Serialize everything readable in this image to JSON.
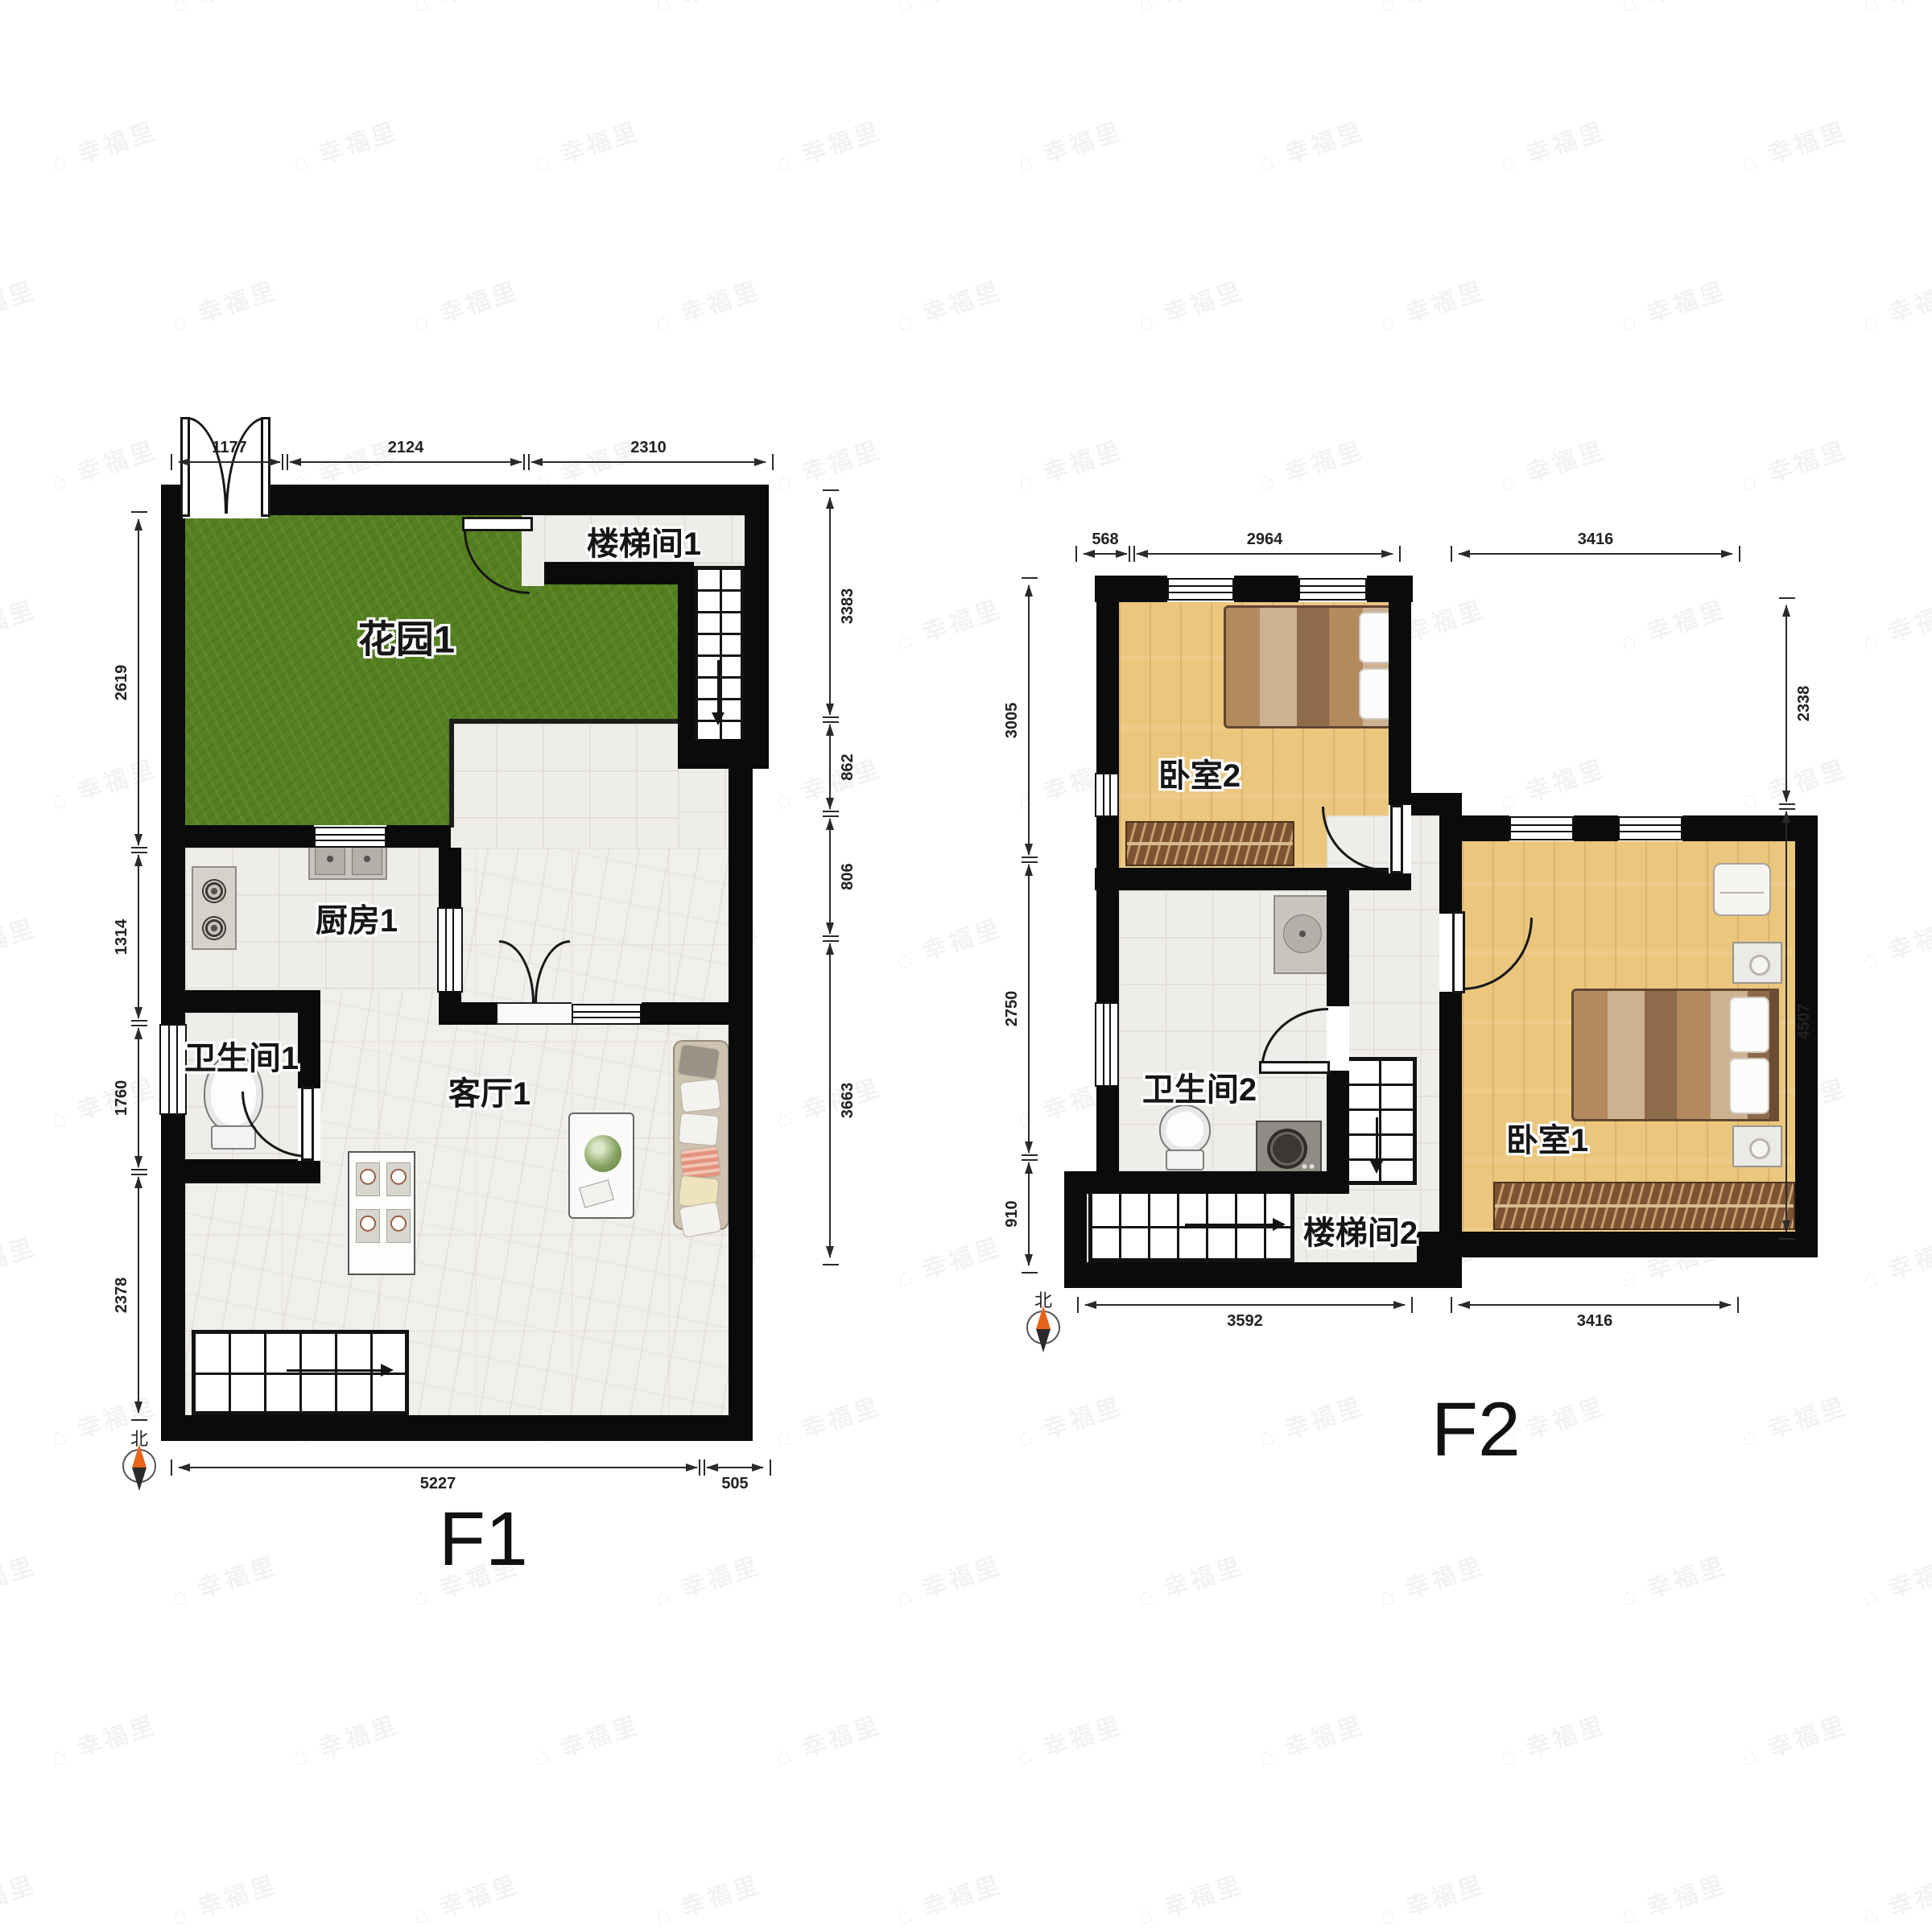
{
  "watermark": {
    "brand": "幸福里",
    "icon_char": "⌂",
    "icon_name": "house-logo-icon"
  },
  "floor1": {
    "title": "F1",
    "compass_label": "北",
    "rooms": {
      "garden": "花园1",
      "stairwell": "楼梯间1",
      "kitchen": "厨房1",
      "bathroom": "卫生间1",
      "living": "客厅1"
    },
    "dims": {
      "top": [
        "1177",
        "2124",
        "2310"
      ],
      "left": [
        "2619",
        "1314",
        "1760",
        "2378"
      ],
      "right": [
        "3383",
        "862",
        "806",
        "3663"
      ],
      "bottom": [
        "5227",
        "505"
      ]
    }
  },
  "floor2": {
    "title": "F2",
    "compass_label": "北",
    "rooms": {
      "bedroom2": "卧室2",
      "bathroom2": "卫生间2",
      "stairwell2": "楼梯间2",
      "bedroom1": "卧室1"
    },
    "dims": {
      "top": [
        "568",
        "2964",
        "3416"
      ],
      "left": [
        "3005",
        "2750",
        "910"
      ],
      "right": [
        "2338",
        "4507"
      ],
      "bottom": [
        "3592",
        "3416"
      ]
    }
  }
}
